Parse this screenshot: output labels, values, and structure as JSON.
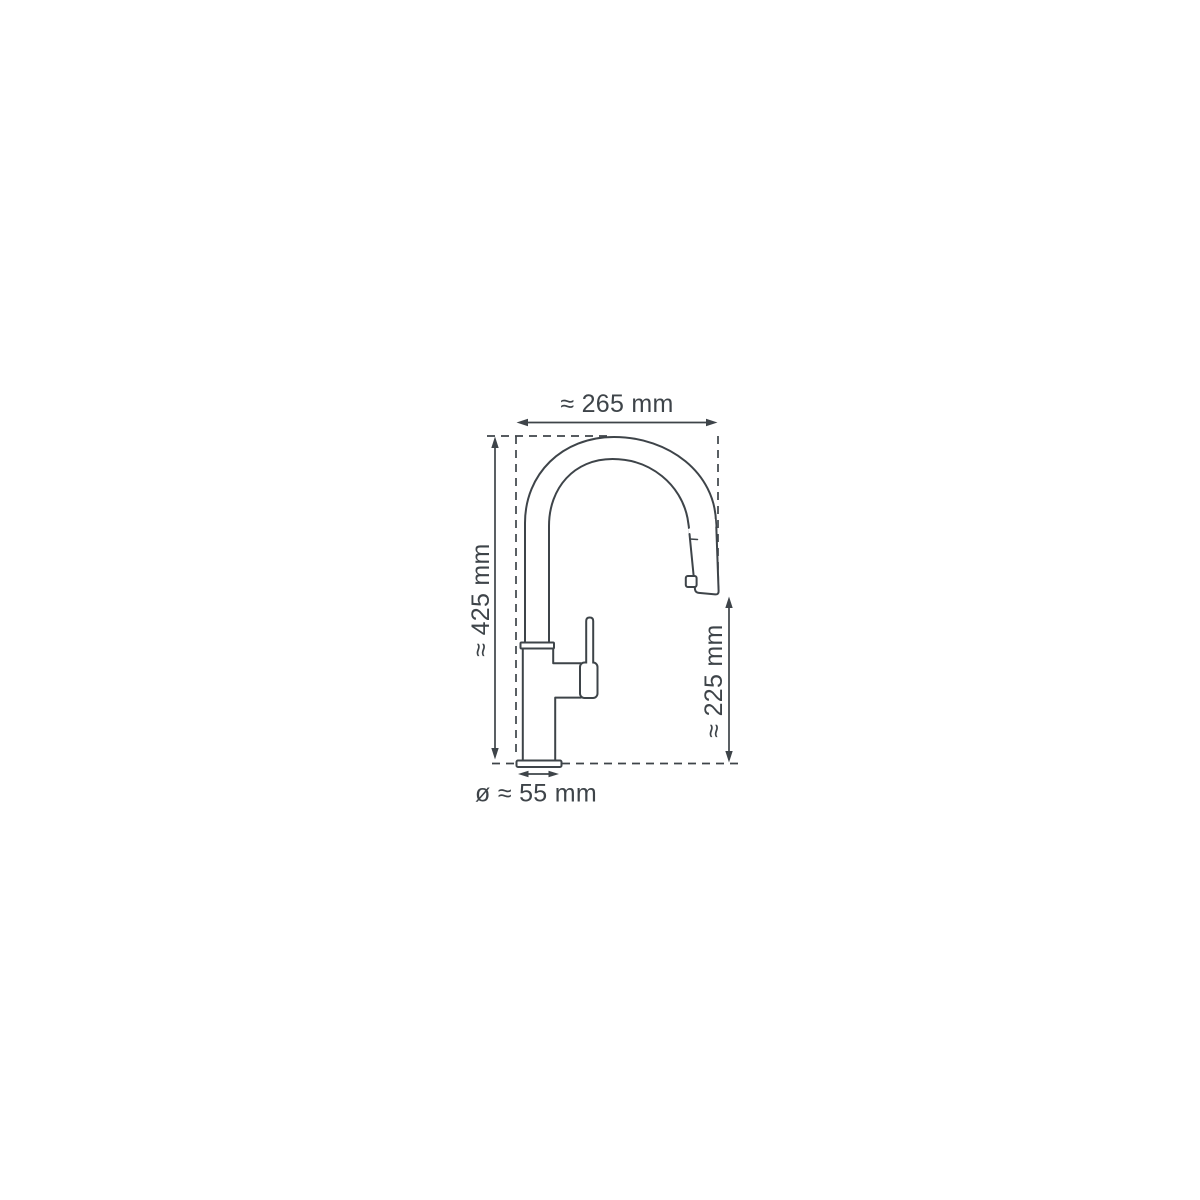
{
  "page": {
    "background_color": "#ffffff"
  },
  "diagram": {
    "subject": "kitchen-faucet-dimension-drawing",
    "line_color": "#3e4449",
    "dimensions": {
      "spout_reach_width": {
        "label": "≈ 265 mm",
        "value_mm": 265,
        "orientation": "horizontal-top"
      },
      "total_height": {
        "label": "≈ 425 mm",
        "value_mm": 425,
        "orientation": "vertical-left"
      },
      "spout_height": {
        "label": "≈ 225 mm",
        "value_mm": 225,
        "orientation": "vertical-right"
      },
      "base_diameter": {
        "label": "ø ≈ 55 mm",
        "value_mm": 55,
        "orientation": "horizontal-bottom"
      }
    }
  }
}
